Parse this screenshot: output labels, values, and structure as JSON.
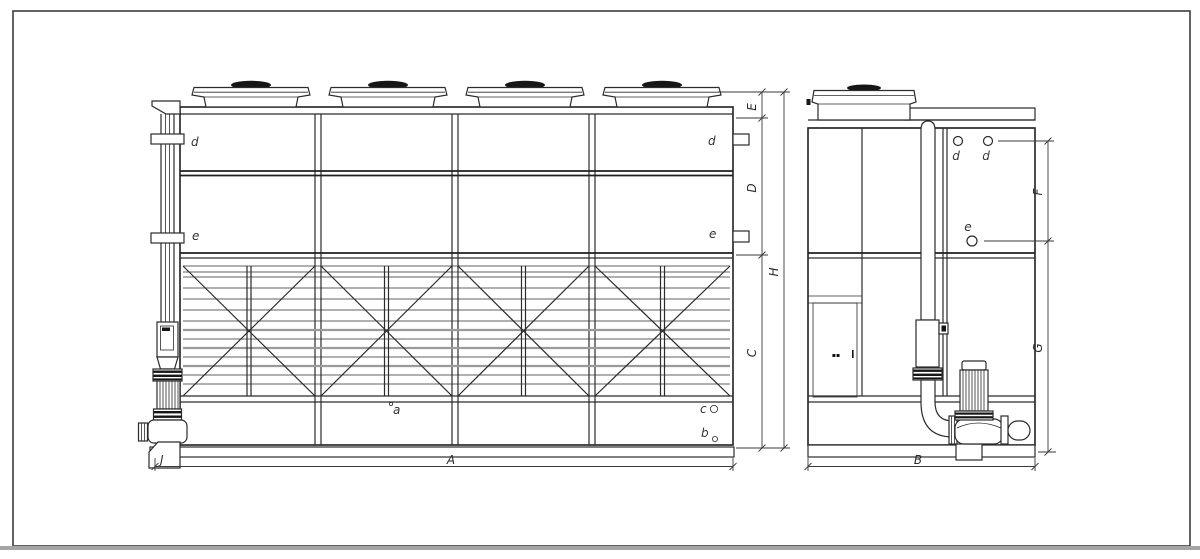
{
  "front_view": {
    "part_labels": {
      "d": "d",
      "e": "e",
      "a": "a",
      "b": "b",
      "c": "c",
      "base_label": "J"
    },
    "dim_labels": {
      "A": "A",
      "C": "C",
      "D": "D",
      "E": "E",
      "H": "H"
    }
  },
  "side_view": {
    "part_labels": {
      "d": "d",
      "e": "e",
      "door_marks": "▪▪"
    },
    "dim_labels": {
      "B": "B",
      "F": "F",
      "G": "G"
    }
  },
  "colors": {
    "line": "#2b2b2b",
    "dark_fill": "#161616",
    "louver_gray": "#9a9a9a",
    "frame": "#3c3c3c",
    "bottom_bar": "#a5a5a5",
    "background": "#ffffff"
  }
}
